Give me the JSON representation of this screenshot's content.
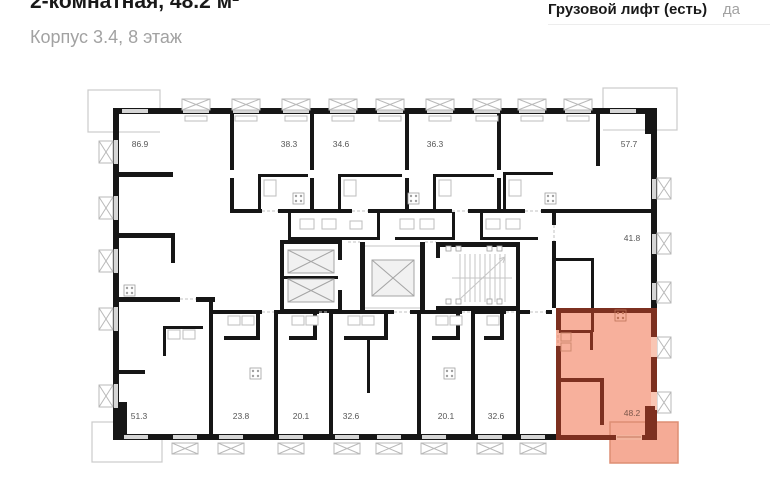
{
  "header": {
    "title": "2-комнатная, 48.2 м²",
    "subtitle": "Корпус 3.4, 8 этаж",
    "spec": {
      "label": "Грузовой лифт (есть)",
      "value": "да"
    }
  },
  "floorplan": {
    "units": [
      {
        "area": "86.9",
        "x": 140,
        "y": 147,
        "highlighted": false
      },
      {
        "area": "38.3",
        "x": 289,
        "y": 147,
        "highlighted": false
      },
      {
        "area": "34.6",
        "x": 341,
        "y": 147,
        "highlighted": false
      },
      {
        "area": "36.3",
        "x": 435,
        "y": 147,
        "highlighted": false
      },
      {
        "area": "57.7",
        "x": 629,
        "y": 147,
        "highlighted": false
      },
      {
        "area": "41.8",
        "x": 632,
        "y": 241,
        "highlighted": false
      },
      {
        "area": "51.3",
        "x": 139,
        "y": 419,
        "highlighted": false
      },
      {
        "area": "23.8",
        "x": 241,
        "y": 419,
        "highlighted": false
      },
      {
        "area": "20.1",
        "x": 301,
        "y": 419,
        "highlighted": false
      },
      {
        "area": "32.6",
        "x": 351,
        "y": 419,
        "highlighted": false
      },
      {
        "area": "20.1",
        "x": 446,
        "y": 419,
        "highlighted": false
      },
      {
        "area": "32.6",
        "x": 496,
        "y": 419,
        "highlighted": false
      },
      {
        "area": "48.2",
        "x": 632,
        "y": 416,
        "highlighted": true
      }
    ],
    "colors": {
      "wall": "#161616",
      "label": "#565656",
      "highlight_fill": "#f7b09c",
      "highlight_wall": "#7d3020",
      "highlight_balcony": "#f5ab96",
      "highlight_label": "#7c574b"
    }
  }
}
